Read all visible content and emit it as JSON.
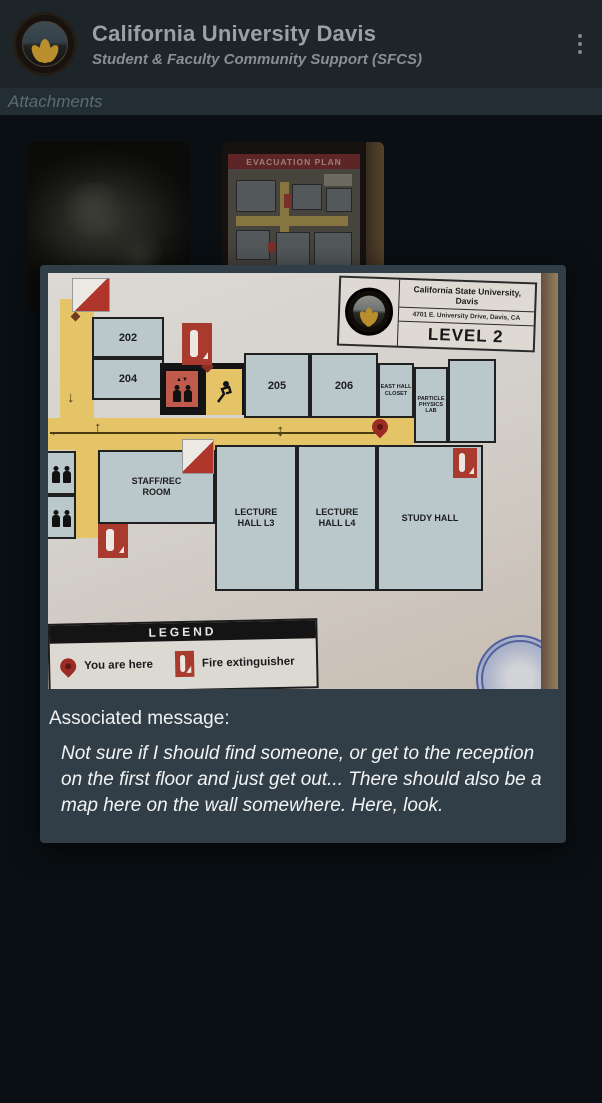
{
  "header": {
    "title": "California University Davis",
    "subtitle": "Student & Faculty Community Support (SFCS)"
  },
  "attachments_bar": {
    "label": "Attachments"
  },
  "thumbnails": {
    "evacuation_banner": "EVACUATION PLAN"
  },
  "modal": {
    "plan": {
      "institution": "California State University, Davis",
      "address": "4701 E. University Drive, Davis, CA",
      "level": "LEVEL 2",
      "rooms": {
        "r202": "202",
        "r204": "204",
        "r205": "205",
        "r206": "206",
        "east_hall_closet": "EAST HALL CLOSET",
        "particle_physics_lab": "PARTICLE PHYSICS LAB",
        "staff_rec_room": "STAFF/REC ROOM",
        "lecture_hall_l3": "LECTURE HALL L3",
        "lecture_hall_l4": "LECTURE HALL L4",
        "study_hall": "STUDY HALL"
      },
      "legend": {
        "title": "LEGEND",
        "you_are_here": "You are here",
        "fire_extinguisher": "Fire extinguisher"
      }
    },
    "associated_message_label": "Associated message:",
    "message": "Not sure if I should find someone, or get to the reception on the first floor and just get out... There should also be a map here on the wall somewhere. Here, look."
  },
  "colors": {
    "card_bg": "#323e47",
    "header_bg": "#1d2529",
    "corridor_yellow": "#e5c467",
    "room_fill": "#bac7cb",
    "plan_red": "#a93a2e"
  }
}
